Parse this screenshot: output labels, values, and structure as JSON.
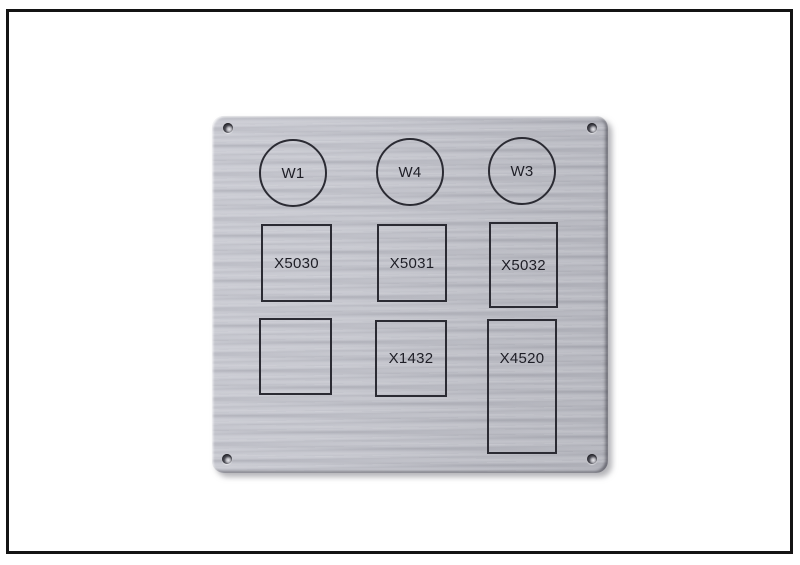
{
  "colors": {
    "background": "#ffffff",
    "frame_border": "#141414",
    "panel_metal": "#bfc0c8",
    "engraving_line": "#2b2b33",
    "label_text": "#1e1e26"
  },
  "panel": {
    "circles": [
      {
        "label": "W1"
      },
      {
        "label": "W4"
      },
      {
        "label": "W3"
      }
    ],
    "boxes": [
      {
        "label": "X5030"
      },
      {
        "label": "X5031"
      },
      {
        "label": "X5032"
      },
      {
        "label": ""
      },
      {
        "label": "X1432"
      },
      {
        "label": "X4520"
      }
    ]
  }
}
